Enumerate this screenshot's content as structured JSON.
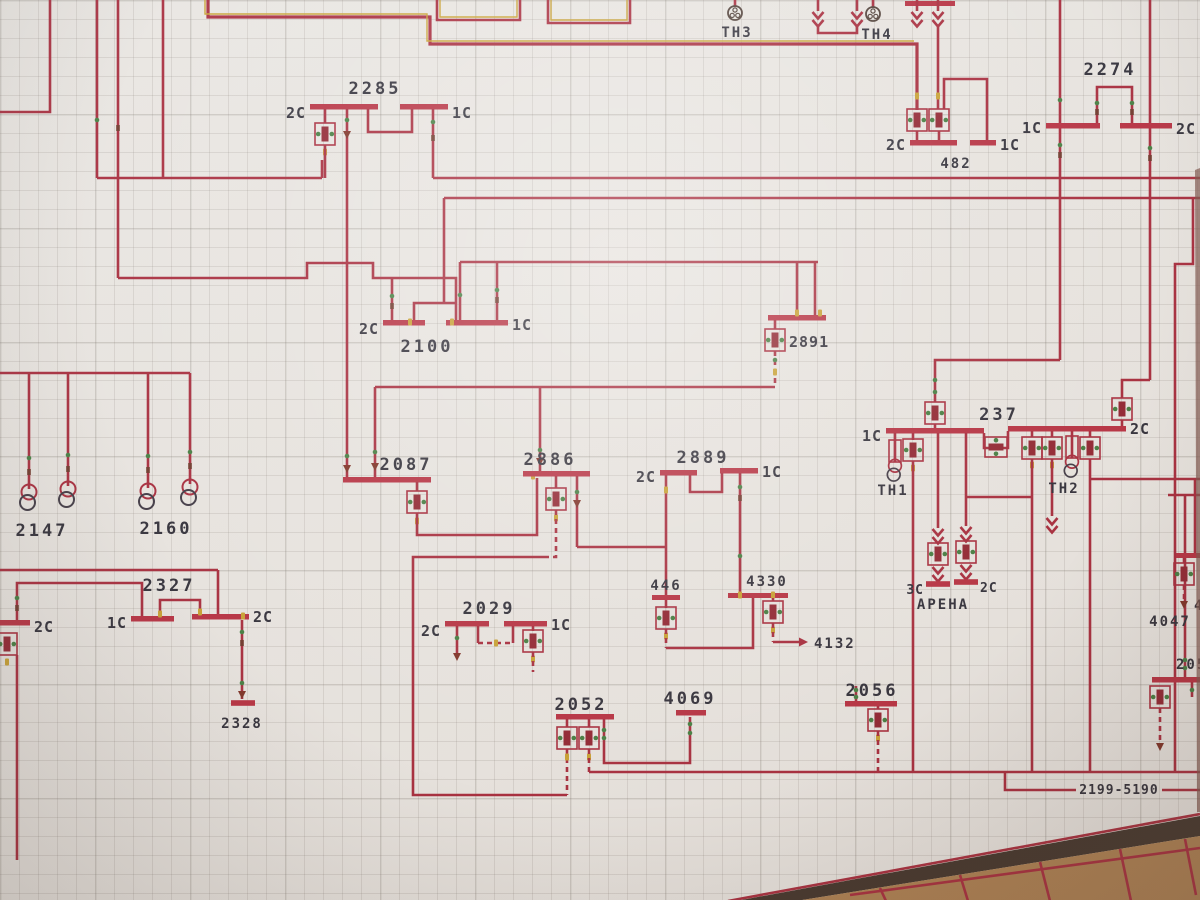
{
  "board": {
    "description": "wall-mounted electrical one-line mimic board photographed at an angle",
    "drawing_number": "2199-5190",
    "grid_cell_px": 19
  },
  "colors": {
    "line": "#a52638",
    "busbar": "#b52b3d",
    "yellow_highlight": "#c79f2d",
    "tick_green": "#3f7a3c",
    "tick_dark": "#6b3226",
    "board_bg": "#e8e5e1",
    "grid": "#78716a",
    "text": "#2b2a35",
    "floor_wood": "#ab7d4d",
    "board_edge": "#3c2e25"
  },
  "labels": [
    {
      "text": "ТН3"
    },
    {
      "text": "ТН4"
    },
    {
      "text": "2274"
    },
    {
      "text": "1С"
    },
    {
      "text": "2С"
    },
    {
      "text": "2С"
    },
    {
      "text": "482"
    },
    {
      "text": "1С"
    },
    {
      "text": "2285"
    },
    {
      "text": "2С"
    },
    {
      "text": "1С"
    },
    {
      "text": "2100"
    },
    {
      "text": "2С"
    },
    {
      "text": "1С"
    },
    {
      "text": "2891"
    },
    {
      "text": "237"
    },
    {
      "text": "1С"
    },
    {
      "text": "2С"
    },
    {
      "text": "ТН1"
    },
    {
      "text": "ТН2"
    },
    {
      "text": "2087"
    },
    {
      "text": "2886"
    },
    {
      "text": "2889"
    },
    {
      "text": "2С"
    },
    {
      "text": "1С"
    },
    {
      "text": "2147"
    },
    {
      "text": "2160"
    },
    {
      "text": "2327"
    },
    {
      "text": "1С"
    },
    {
      "text": "2С"
    },
    {
      "text": "2С"
    },
    {
      "text": "2328"
    },
    {
      "text": "2029"
    },
    {
      "text": "2С"
    },
    {
      "text": "1С"
    },
    {
      "text": "446"
    },
    {
      "text": "4330"
    },
    {
      "text": "4132"
    },
    {
      "text": "3С"
    },
    {
      "text": "2С"
    },
    {
      "text": "АРЕНА"
    },
    {
      "text": "2052"
    },
    {
      "text": "4069"
    },
    {
      "text": "2056"
    },
    {
      "text": "4047"
    },
    {
      "text": "2055"
    },
    {
      "text": "2199-5190"
    },
    {
      "text": "4"
    }
  ]
}
